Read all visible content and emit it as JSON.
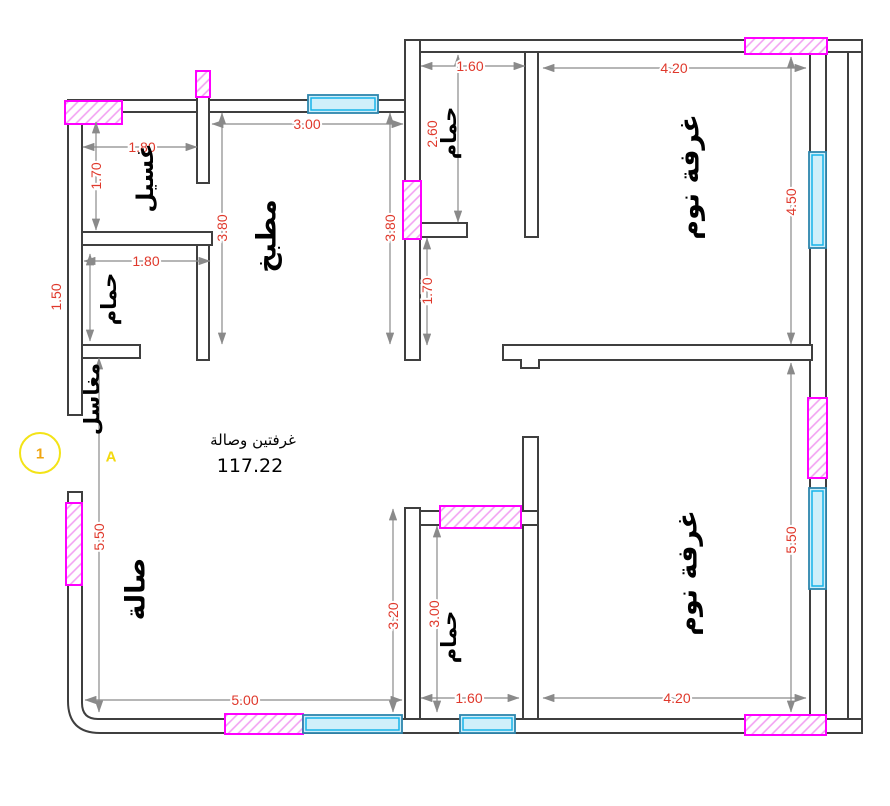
{
  "drawing": {
    "center_label": "غرفتين وصالة",
    "center_area": "117.22"
  },
  "rooms": {
    "laundry": "غسيل",
    "bath_top_left": "حمام",
    "sinks": "مغاسل",
    "kitchen": "مطبخ",
    "bath_top": "حمام",
    "bedroom_top": "غرفة نوم",
    "hall": "صالة",
    "bath_bottom": "حمام",
    "bedroom_bottom": "غرفة نوم"
  },
  "dimensions": {
    "laundry_width": "1.80",
    "laundry_height": "1.70",
    "kitchen_width": "3.00",
    "kitchen_height_left": "3.80",
    "kitchen_height_right": "3.80",
    "bath_top_width": "1.60",
    "bath_top_height": "2.60",
    "bath_top_lower": "1.70",
    "bedroom_top_width": "4.20",
    "bedroom_top_height": "4.50",
    "bath_tl_width": "1.80",
    "bath_tl_height": "1.50",
    "hall_height": "5.50",
    "hall_width": "5.00",
    "passage_height": "3.20",
    "bath_bottom_height": "3.00",
    "bath_bottom_width": "1.60",
    "bedroom_bottom_width": "4.20",
    "bedroom_bottom_height": "5.50"
  },
  "marker": {
    "number": "1",
    "letter": "A"
  },
  "colors": {
    "wall": "#3f3f3f",
    "dimension_text": "#df382b",
    "dimension_line": "#8a8a8a",
    "door_hatch": "#ff00ff",
    "window_frame": "#2e86ad",
    "window_glass": "#17b4e9",
    "section_marker": "#f3e317"
  }
}
